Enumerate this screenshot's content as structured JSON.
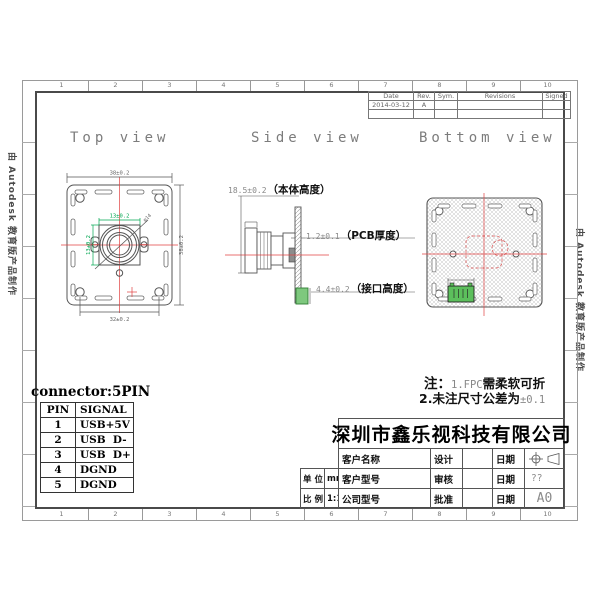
{
  "watermark": {
    "text": "由 Autodesk 教育版产品制作"
  },
  "border": {
    "cols": [
      "1",
      "2",
      "3",
      "4",
      "5",
      "6",
      "7",
      "8",
      "9",
      "10"
    ]
  },
  "revision_table": {
    "headers": [
      "Date",
      "Rev.",
      "Sym.",
      "Revisions",
      "Signed"
    ],
    "row": {
      "date": "2014-03-12",
      "rev": "A",
      "sym": "",
      "revisions": "",
      "signed": ""
    }
  },
  "views": {
    "top": {
      "title": "Top view"
    },
    "side": {
      "title": "Side view"
    },
    "bottom": {
      "title": "Bottom view"
    }
  },
  "top_view": {
    "dim_top": "38±0.2",
    "dim_right": "38±0.2",
    "dim_bottom": "32±0.2",
    "dim_lens_h": "13±0.2",
    "dim_lens_v": "13±0.2",
    "dim_diag": "φ14"
  },
  "side_view": {
    "v1": "18.5±0.2",
    "l1": "（本体高度）",
    "v2": "1.2±0.1",
    "l2": "（PCB厚度）",
    "v3": "4.4±0.2",
    "l3": "（接口高度）"
  },
  "notes": {
    "prefix": "注：",
    "n1": "1.FPC",
    "t1": "需柔软可折",
    "n2": "2.",
    "t2": "未注尺寸公差为",
    "v2": "±0.1"
  },
  "connector": {
    "title": "connector:5PIN",
    "headers": [
      "PIN",
      "SIGNAL"
    ],
    "rows": [
      [
        "1",
        "USB+5V"
      ],
      [
        "2",
        "USB  D-"
      ],
      [
        "3",
        "USB  D+"
      ],
      [
        "4",
        "DGND"
      ],
      [
        "5",
        "DGND"
      ]
    ]
  },
  "title_block": {
    "company": "深圳市鑫乐视科技有限公司",
    "customer_name": "客户名称",
    "customer_model": "客户型号",
    "company_model": "公司型号",
    "unit_label": "单 位",
    "unit_value": "mm",
    "scale_label": "比 例",
    "scale_value": "1:1",
    "design": "设计",
    "review": "审核",
    "approve": "批准",
    "date": "日期",
    "sheet": "??",
    "size": "A0"
  },
  "colors": {
    "red": "#e04040",
    "green": "#00a650",
    "line": "#4a4a4a"
  }
}
